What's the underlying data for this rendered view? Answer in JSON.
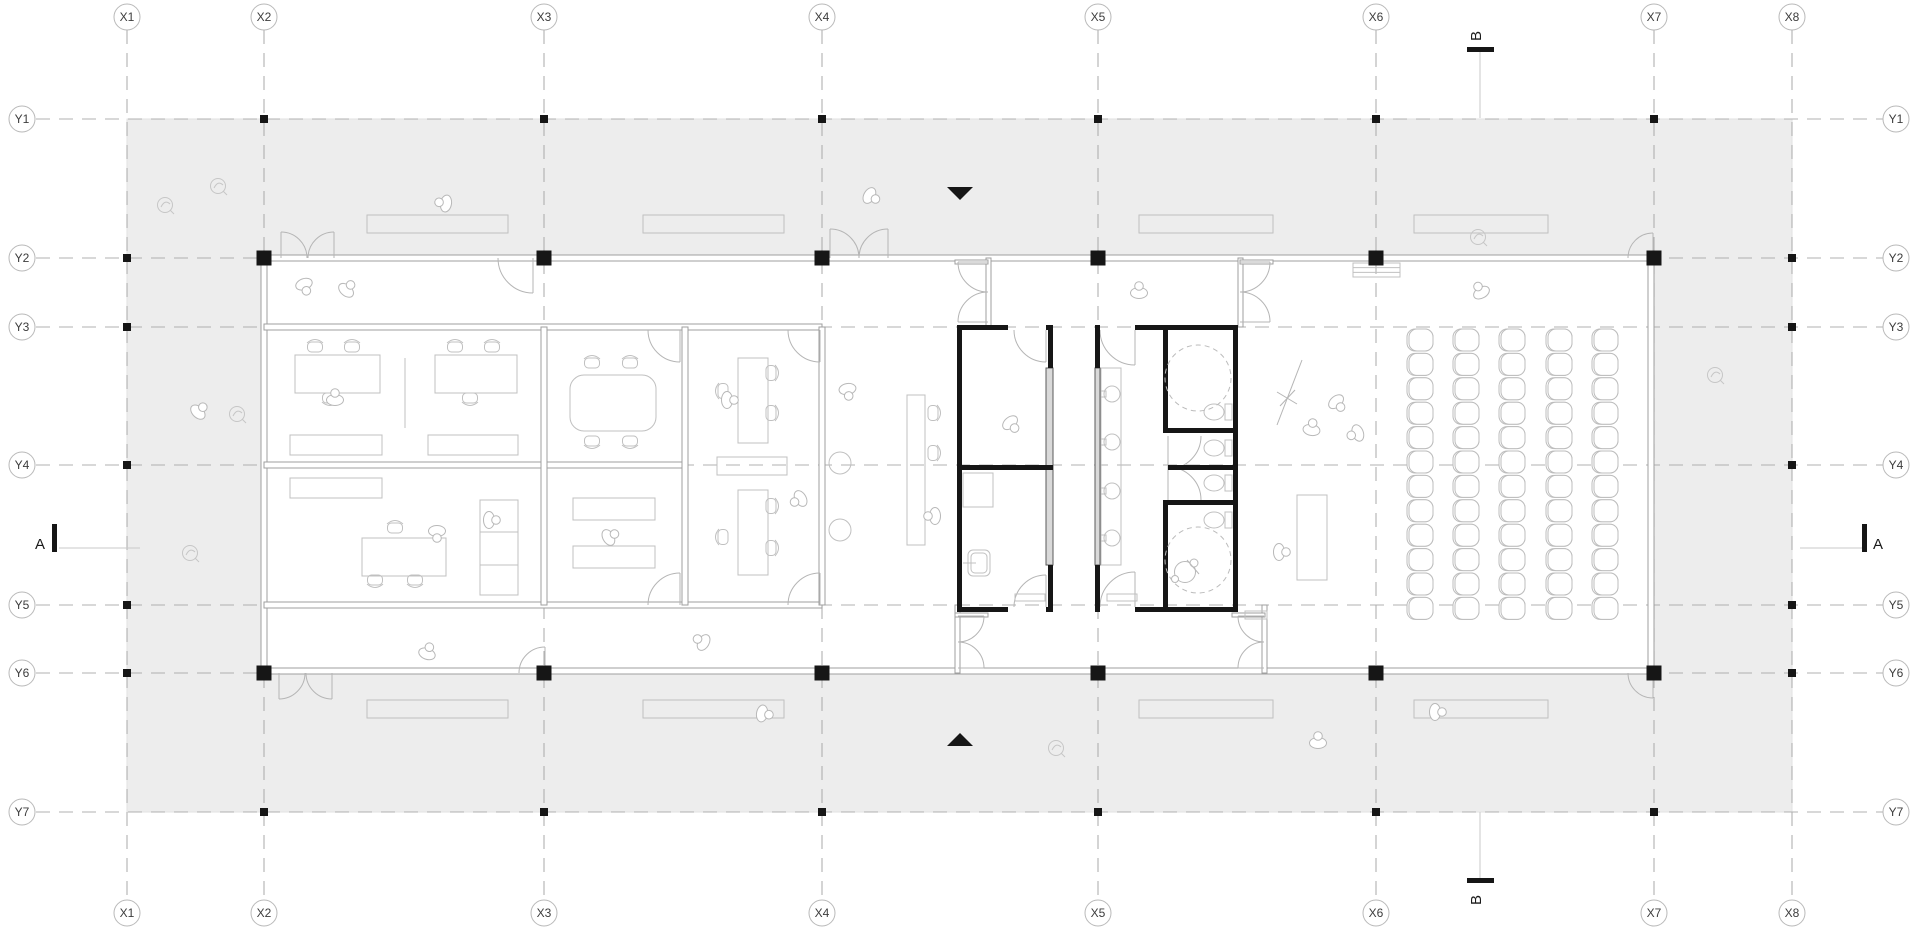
{
  "canvas": {
    "w": 1920,
    "h": 937
  },
  "colors": {
    "slab": "#ededed",
    "floor": "#ffffff",
    "accent_black": "#161616",
    "line_light": "#c0c0c0",
    "line_mid": "#9f9f9f",
    "grid_line": "#b0b0b0",
    "label_text": "#3c3c3c"
  },
  "grid": {
    "x_axes": [
      {
        "label": "X1",
        "pos": 127
      },
      {
        "label": "X2",
        "pos": 264
      },
      {
        "label": "X3",
        "pos": 544
      },
      {
        "label": "X4",
        "pos": 822
      },
      {
        "label": "X5",
        "pos": 1098
      },
      {
        "label": "X6",
        "pos": 1376
      },
      {
        "label": "X7",
        "pos": 1654
      },
      {
        "label": "X8",
        "pos": 1792
      }
    ],
    "y_axes": [
      {
        "label": "Y1",
        "pos": 119
      },
      {
        "label": "Y2",
        "pos": 258
      },
      {
        "label": "Y3",
        "pos": 327
      },
      {
        "label": "Y4",
        "pos": 465
      },
      {
        "label": "Y5",
        "pos": 605
      },
      {
        "label": "Y6",
        "pos": 673
      },
      {
        "label": "Y7",
        "pos": 812
      }
    ],
    "bubble_r": 13,
    "top_cy": 17,
    "bottom_cy": 913,
    "left_cx": 22,
    "right_cx": 1896,
    "v_span": [
      30,
      900
    ],
    "h_span": [
      36,
      1883
    ]
  },
  "slab": [
    127,
    119,
    1665,
    693
  ],
  "building": [
    264,
    258,
    1390,
    415
  ],
  "section_markers": [
    {
      "label": "A",
      "letter": [
        40,
        549
      ],
      "rot": 0,
      "bar": [
        52,
        524,
        5,
        28
      ],
      "line": [
        59,
        548,
        140,
        548
      ]
    },
    {
      "label": "A",
      "letter": [
        1878,
        549
      ],
      "rot": 0,
      "bar": [
        1862,
        524,
        5,
        28
      ],
      "line": [
        1800,
        548,
        1862,
        548
      ]
    },
    {
      "label": "B",
      "letter": [
        1481,
        36
      ],
      "rot": -90,
      "bar": [
        1467,
        47,
        27,
        5
      ],
      "line": [
        1480,
        52,
        1480,
        118
      ]
    },
    {
      "label": "B",
      "letter": [
        1481,
        900
      ],
      "rot": -90,
      "bar": [
        1467,
        878,
        27,
        5
      ],
      "line": [
        1480,
        812,
        1480,
        878
      ]
    }
  ],
  "entrance_arrows": [
    {
      "dir": "down",
      "points": "947,187 973,187 960,200"
    },
    {
      "dir": "up",
      "points": "947,746 973,746 960,733"
    }
  ],
  "columns": {
    "large_size": 15,
    "small_size": 8,
    "large": [
      [
        264,
        258
      ],
      [
        544,
        258
      ],
      [
        822,
        258
      ],
      [
        1098,
        258
      ],
      [
        1376,
        258
      ],
      [
        1654,
        258
      ],
      [
        264,
        673
      ],
      [
        544,
        673
      ],
      [
        822,
        673
      ],
      [
        1098,
        673
      ],
      [
        1376,
        673
      ],
      [
        1654,
        673
      ]
    ],
    "small": [
      [
        264,
        119
      ],
      [
        544,
        119
      ],
      [
        822,
        119
      ],
      [
        1098,
        119
      ],
      [
        1376,
        119
      ],
      [
        1654,
        119
      ],
      [
        264,
        812
      ],
      [
        544,
        812
      ],
      [
        822,
        812
      ],
      [
        1098,
        812
      ],
      [
        1376,
        812
      ],
      [
        1654,
        812
      ],
      [
        127,
        258
      ],
      [
        127,
        327
      ],
      [
        127,
        465
      ],
      [
        127,
        605
      ],
      [
        127,
        673
      ],
      [
        1792,
        258
      ],
      [
        1792,
        327
      ],
      [
        1792,
        465
      ],
      [
        1792,
        605
      ],
      [
        1792,
        673
      ]
    ]
  },
  "walls": {
    "thin": [
      [
        264,
        255,
        1390,
        6
      ],
      [
        264,
        668,
        1390,
        6
      ],
      [
        261,
        258,
        6,
        415
      ],
      [
        1648,
        258,
        6,
        415
      ],
      [
        264,
        324,
        558,
        6
      ],
      [
        264,
        602,
        558,
        6
      ],
      [
        264,
        462,
        421,
        6
      ],
      [
        541,
        327,
        6,
        278
      ],
      [
        682,
        327,
        6,
        278
      ],
      [
        819,
        327,
        6,
        278
      ]
    ],
    "glass": [
      [
        986,
        258,
        5,
        69
      ],
      [
        1238,
        258,
        5,
        69
      ],
      [
        955,
        605,
        5,
        68
      ],
      [
        1262,
        605,
        5,
        68
      ]
    ],
    "stubs": [
      [
        955,
        260,
        33,
        4
      ],
      [
        1240,
        260,
        33,
        4
      ],
      [
        955,
        613,
        33,
        4
      ],
      [
        1232,
        613,
        33,
        4
      ]
    ],
    "thick": [
      [
        957,
        325,
        51,
        5
      ],
      [
        1046,
        325,
        7,
        5
      ],
      [
        957,
        607,
        51,
        5
      ],
      [
        1046,
        607,
        7,
        5
      ],
      [
        957,
        325,
        5,
        287
      ],
      [
        1048,
        325,
        5,
        43
      ],
      [
        1048,
        565,
        5,
        47
      ],
      [
        957,
        465,
        96,
        5
      ],
      [
        1095,
        325,
        4,
        5
      ],
      [
        1135,
        325,
        103,
        5
      ],
      [
        1095,
        607,
        4,
        5
      ],
      [
        1135,
        607,
        103,
        5
      ],
      [
        1233,
        325,
        5,
        287
      ],
      [
        1095,
        325,
        5,
        43
      ],
      [
        1095,
        565,
        5,
        47
      ],
      [
        1163,
        330,
        5,
        102
      ],
      [
        1163,
        428,
        75,
        5
      ],
      [
        1168,
        465,
        70,
        5
      ],
      [
        1163,
        500,
        75,
        5
      ],
      [
        1163,
        505,
        5,
        107
      ]
    ],
    "gray_strips": [
      [
        1046,
        368,
        7,
        197
      ],
      [
        1095,
        368,
        5,
        197
      ]
    ]
  },
  "doors": [
    [
      281,
      258,
      26,
      0,
      -90
    ],
    [
      334,
      258,
      26,
      180,
      270
    ],
    [
      830,
      258,
      29,
      0,
      -90
    ],
    [
      888,
      258,
      29,
      180,
      270
    ],
    [
      1653,
      258,
      25,
      180,
      270
    ],
    [
      279,
      673,
      26,
      0,
      90
    ],
    [
      332,
      673,
      26,
      180,
      90
    ],
    [
      545,
      673,
      26,
      180,
      270
    ],
    [
      533,
      258,
      35,
      180,
      90
    ],
    [
      1653,
      673,
      25,
      180,
      90
    ],
    [
      680,
      330,
      32,
      180,
      90
    ],
    [
      680,
      605,
      32,
      180,
      270
    ],
    [
      820,
      330,
      32,
      180,
      90
    ],
    [
      820,
      605,
      32,
      180,
      270
    ],
    [
      1046,
      330,
      32,
      180,
      90
    ],
    [
      1046,
      607,
      32,
      180,
      270
    ],
    [
      1135,
      330,
      35,
      180,
      90
    ],
    [
      1135,
      607,
      35,
      180,
      270
    ],
    [
      988,
      262,
      30,
      90,
      180
    ],
    [
      988,
      322,
      30,
      270,
      180
    ],
    [
      1240,
      262,
      30,
      90,
      0
    ],
    [
      1240,
      322,
      30,
      270,
      360
    ],
    [
      958,
      616,
      26,
      90,
      0
    ],
    [
      958,
      668,
      26,
      270,
      360
    ],
    [
      1264,
      616,
      26,
      90,
      180
    ],
    [
      1264,
      668,
      26,
      270,
      180
    ],
    [
      1168,
      436,
      33,
      0,
      90
    ],
    [
      1168,
      500,
      33,
      0,
      -90
    ]
  ],
  "furniture": {
    "desks": [
      [
        295,
        355,
        85,
        38
      ],
      [
        435,
        355,
        82,
        38
      ],
      [
        362,
        538,
        84,
        38
      ],
      [
        738,
        358,
        30,
        85
      ],
      [
        717,
        457,
        70,
        18
      ],
      [
        738,
        490,
        30,
        85
      ],
      [
        907,
        395,
        18,
        150
      ],
      [
        1297,
        495,
        30,
        85
      ],
      [
        1101,
        368,
        20,
        197
      ]
    ],
    "shelves": [
      [
        290,
        435,
        92,
        20
      ],
      [
        428,
        435,
        90,
        20
      ],
      [
        290,
        478,
        92,
        20
      ],
      [
        573,
        498,
        82,
        22
      ],
      [
        573,
        546,
        82,
        22
      ],
      [
        963,
        473,
        30,
        34
      ],
      [
        1015,
        594,
        30,
        7
      ],
      [
        1107,
        594,
        30,
        7
      ],
      [
        1245,
        611,
        22,
        8
      ]
    ],
    "meeting_table": {
      "rect": [
        570,
        375,
        86,
        56
      ],
      "rx": 14
    },
    "sofa": {
      "rect": [
        480,
        500,
        38,
        95
      ],
      "lines": [
        532,
        565
      ]
    },
    "round_tables": [
      [
        840,
        463,
        11
      ],
      [
        840,
        530,
        11
      ]
    ],
    "divider_line": [
      405,
      358,
      405,
      428
    ],
    "desk_chairs": [
      [
        315,
        346,
        0
      ],
      [
        352,
        346,
        0
      ],
      [
        330,
        399,
        180
      ],
      [
        455,
        346,
        0
      ],
      [
        492,
        346,
        0
      ],
      [
        470,
        399,
        180
      ],
      [
        592,
        362,
        0
      ],
      [
        630,
        362,
        0
      ],
      [
        592,
        442,
        180
      ],
      [
        630,
        442,
        180
      ],
      [
        395,
        527,
        0
      ],
      [
        375,
        581,
        180
      ],
      [
        415,
        581,
        180
      ],
      [
        772,
        373,
        90
      ],
      [
        772,
        413,
        90
      ],
      [
        722,
        391,
        270
      ],
      [
        772,
        506,
        90
      ],
      [
        772,
        548,
        90
      ],
      [
        722,
        537,
        270
      ],
      [
        934,
        413,
        90
      ],
      [
        934,
        453,
        90
      ]
    ],
    "benches": [
      [
        367,
        215,
        141,
        18
      ],
      [
        643,
        215,
        141,
        18
      ],
      [
        1139,
        215,
        134,
        18
      ],
      [
        1414,
        215,
        134,
        18
      ],
      [
        367,
        700,
        141,
        18
      ],
      [
        643,
        700,
        141,
        18
      ],
      [
        1139,
        700,
        134,
        18
      ],
      [
        1414,
        700,
        134,
        18
      ]
    ],
    "hatch_bench": [
      1353,
      263,
      47,
      14
    ],
    "seating": {
      "col_cx": [
        1420,
        1466,
        1512,
        1559,
        1605
      ],
      "row_start": 340,
      "row_step": 24.4,
      "row_count": 12,
      "seat_w": 26,
      "seat_h": 22
    }
  },
  "sanitary": {
    "wc_fixtures": [
      [
        1214,
        412
      ],
      [
        1214,
        448
      ],
      [
        1214,
        483
      ],
      [
        1214,
        520
      ]
    ],
    "basins_cx": 1112,
    "basins_cy": [
      394,
      442,
      491,
      538
    ],
    "accessible_circles": [
      [
        1198,
        378,
        33
      ],
      [
        1198,
        560,
        33
      ]
    ],
    "wheelchair": [
      1185,
      572
    ],
    "sink": [
      968,
      550
    ]
  },
  "figures": {
    "people": [
      [
        305,
        287,
        160
      ],
      [
        348,
        288,
        40
      ],
      [
        443,
        203,
        -80
      ],
      [
        872,
        197,
        120
      ],
      [
        1139,
        290,
        0
      ],
      [
        1480,
        290,
        -30
      ],
      [
        1312,
        427,
        10
      ],
      [
        1338,
        404,
        140
      ],
      [
        1355,
        434,
        -110
      ],
      [
        1282,
        552,
        90
      ],
      [
        848,
        392,
        170
      ],
      [
        932,
        516,
        -90
      ],
      [
        1012,
        425,
        140
      ],
      [
        335,
        397,
        0
      ],
      [
        492,
        520,
        90
      ],
      [
        437,
        534,
        180
      ],
      [
        611,
        536,
        60
      ],
      [
        730,
        400,
        90
      ],
      [
        798,
        500,
        -120
      ],
      [
        428,
        651,
        20
      ],
      [
        701,
        641,
        -60
      ],
      [
        765,
        714,
        100
      ],
      [
        1438,
        712,
        90
      ],
      [
        1318,
        740,
        0
      ],
      [
        200,
        410,
        45
      ]
    ],
    "plants": [
      [
        165,
        205
      ],
      [
        218,
        186
      ],
      [
        237,
        414
      ],
      [
        190,
        553
      ],
      [
        1715,
        375
      ],
      [
        1056,
        748
      ],
      [
        1478,
        237
      ]
    ],
    "marks": [
      [
        1302,
        360,
        1277,
        425
      ],
      [
        1277,
        392,
        1297,
        404
      ],
      [
        1280,
        406,
        1295,
        390
      ]
    ]
  }
}
